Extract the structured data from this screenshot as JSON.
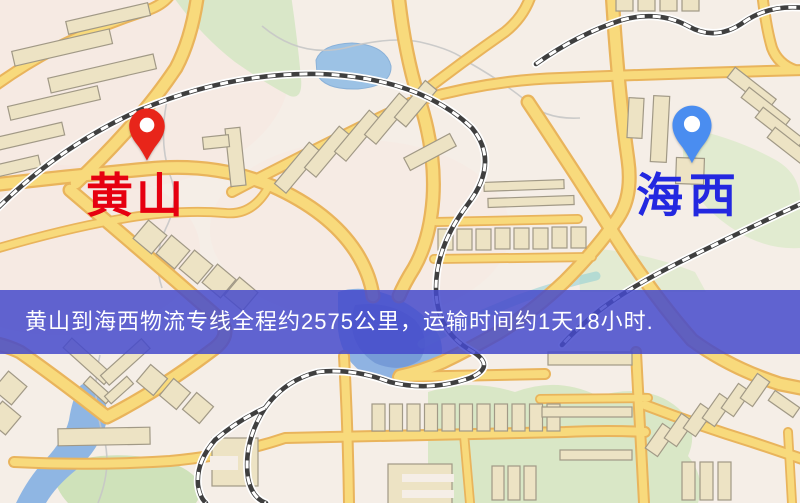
{
  "map": {
    "kind": "logistics-route-map",
    "markers": [
      {
        "id": "origin",
        "label": "黄山",
        "pin_icon": "red-map-pin-icon",
        "pin_color": "#e8251a",
        "label_color": "#e60010"
      },
      {
        "id": "destination",
        "label": "海西",
        "pin_icon": "blue-map-pin-icon",
        "pin_color": "#4a8df0",
        "label_color": "#2328e0"
      }
    ],
    "banner": {
      "text": "黄山到海西物流专线全程约2575公里，运输时间约1天18小时.",
      "origin": "黄山",
      "destination": "海西",
      "distance_text": "约2575公里",
      "duration_text": "约1天18小时",
      "background_color": "#454acb",
      "text_color": "#ffffff"
    },
    "colors": {
      "map_background": "#f5eee7",
      "road_fill": "#f8da7c",
      "road_casing": "#e9b45c",
      "water": "#8fb3e2",
      "park_green": "#d9e7c8",
      "building_fill": "#ede3c4",
      "railway_dark": "#3f3f3f"
    }
  }
}
